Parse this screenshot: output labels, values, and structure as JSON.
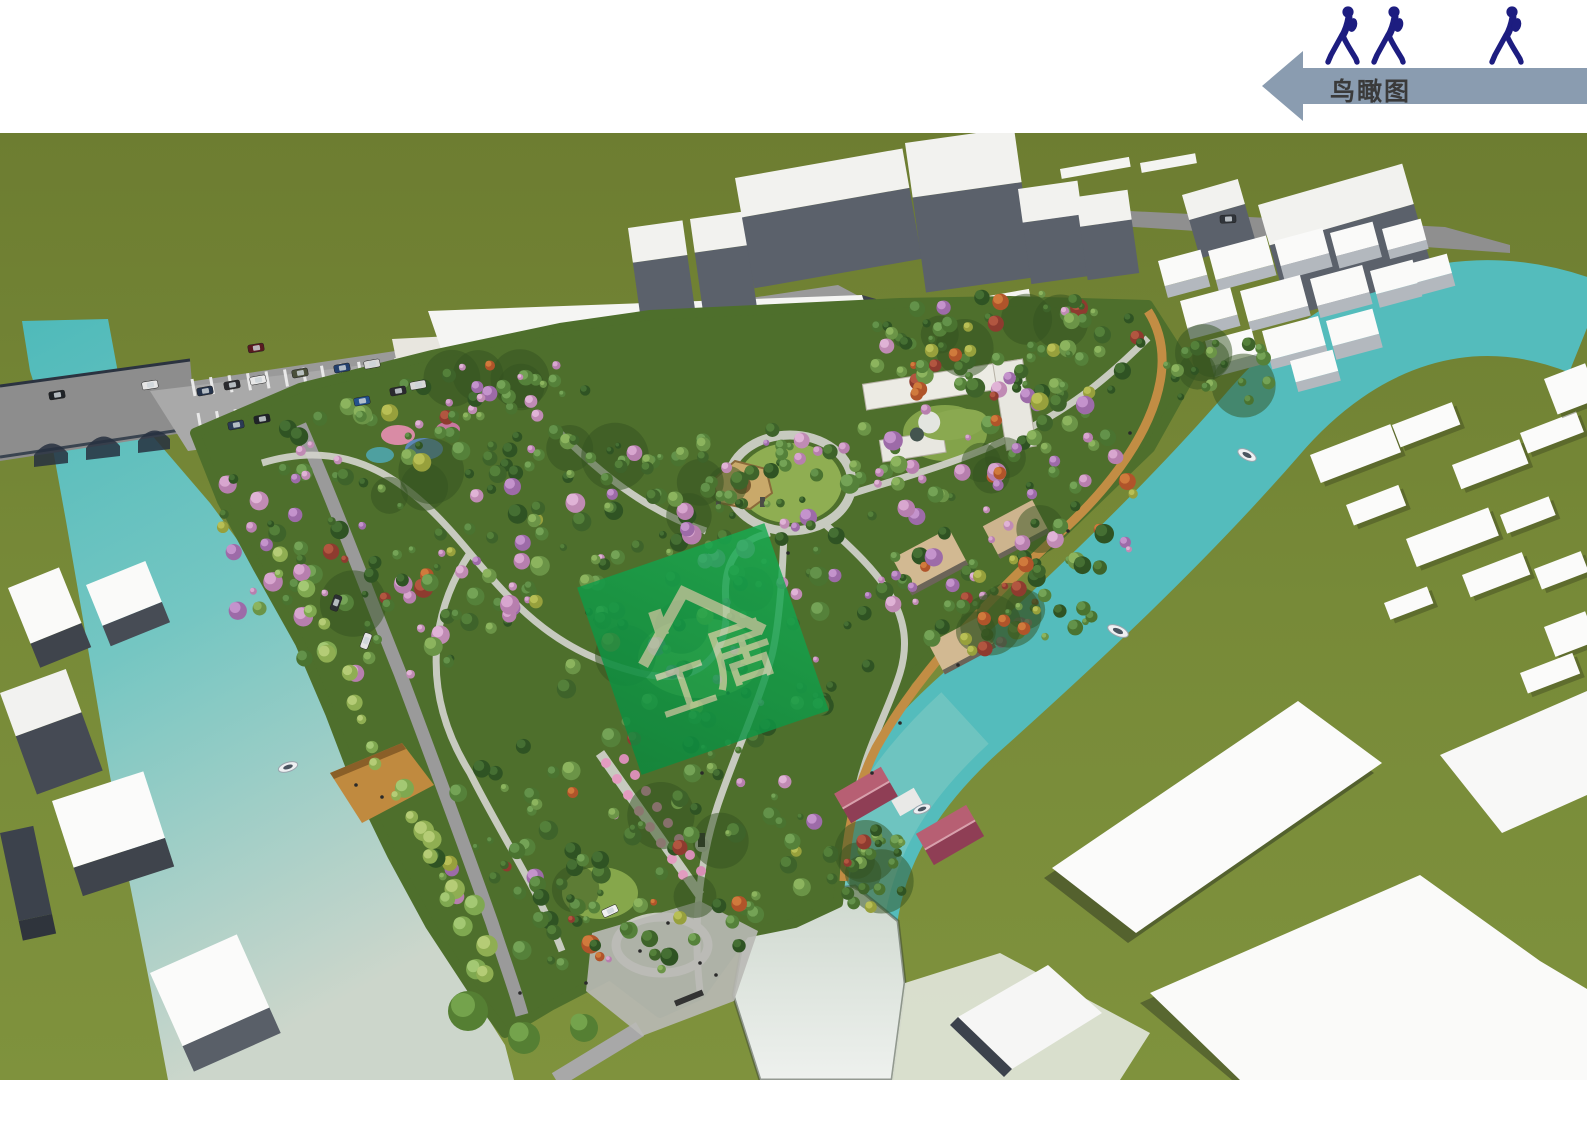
{
  "header": {
    "label": "鸟瞰图",
    "arrow_direction": "left",
    "arrow_color": "#8a9cb0",
    "label_color": "#3a3a3a",
    "walker_icon": "walking-person-icon",
    "walker_count": 3,
    "walker_color": "#1d1d80"
  },
  "watermark": {
    "icon": "house-icon",
    "text_left": "工",
    "text_right": "居",
    "color": "#0fa24a",
    "glyph_color": "#d9d2ae"
  },
  "scene": {
    "type": "aerial-3d-render",
    "subject": "riverside park landscape design bird's-eye view",
    "boats_visible": 4,
    "colors": {
      "grass": "#748b37",
      "water_teal": "#54bcbc",
      "water_pale": "#ccd6cb",
      "road": "#9a9a9a",
      "building_top": "#f5f5f3",
      "building_face": "#565c66",
      "tree_green": "#4e7a2f",
      "tree_blossom": "#b77fae",
      "pavilion_roof": "#c9a96a",
      "riverfront_roof": "#cdb48e",
      "house_roof_maroon": "#a04a60",
      "boardwalk_wood": "#c28d44"
    },
    "features": [
      "river",
      "bridge-with-cars",
      "parking-lot",
      "dense-park-trees",
      "central-pagoda-pavilion",
      "courtyard-buildings",
      "riverfront-pavilions",
      "entrance-plaza",
      "pond",
      "boardwalk",
      "playground-mounds",
      "white-massing-buildings",
      "village-blocks",
      "boats"
    ]
  }
}
